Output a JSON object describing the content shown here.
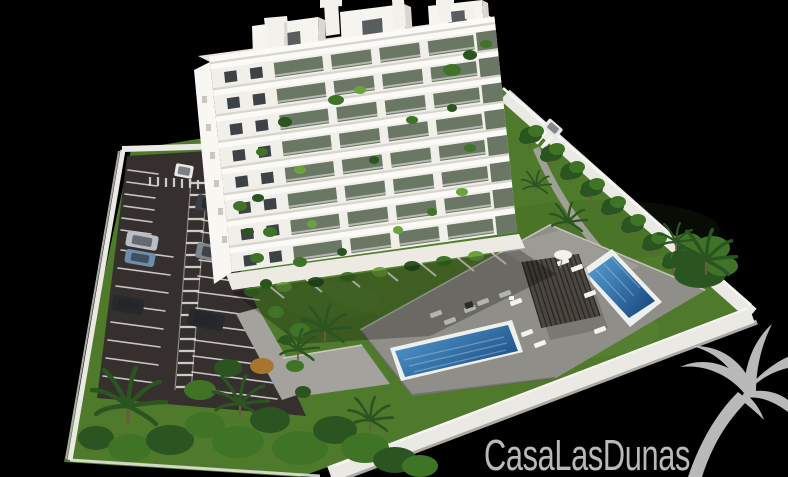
{
  "scene": {
    "type": "architectural-3d-rendering",
    "watermark_text": "CasaLasDunas",
    "watermark_icon": "palm-tree",
    "description": "Aerial 3D render of a white 8-storey apartment building with balcony plants, a striped parking lot with parked cars, landscaped gardens with palm trees, a grey sun deck with two blue swimming pools and a slatted pergola, enclosed by a white perimeter wall on a black background."
  },
  "colors": {
    "background": "#000000",
    "facade": "#f1efe9",
    "facade-left": "#f8f7f2",
    "roof": "#e7e5de",
    "penthouse": "#f5f4ee",
    "penthouse-side": "#d9d7cf",
    "chimney": "#f2f1ec",
    "slab": "#fbfaf6",
    "slab-shadow": "#d8d5cd",
    "glass": "#6b7765",
    "window": "#3d4246",
    "base-band": "#eceae3",
    "lawn": "#4f7a2b",
    "lawn-light": "#76a447",
    "lawn-dark": "#2f5519",
    "asphalt": "#35302e",
    "stripe": "#d4d4d2",
    "wall": "#eae9e3",
    "wall-highlight": "#f7f6f2",
    "wall-shade": "#aaa9a3",
    "deck": "#8f8e88",
    "deck-light": "#a9a8a1",
    "path": "#a3a29c",
    "pool-border": "#eef0ee",
    "pool-light": "#58a0d2",
    "pool-dark": "#1c4e86",
    "pergola": "#45403a",
    "pergola-slat": "#2a2723",
    "lounger": "#f2f2ef",
    "foliage": "#3f7427",
    "foliage-dark": "#2a5420",
    "foliage-light": "#6ca23c",
    "bush-orange": "#a8752f",
    "car-white": "#e9e9e7",
    "car-silver": "#b7bec4",
    "car-blue": "#6d8dac",
    "car-gray": "#7e868d",
    "car-dark": "#3a3f44",
    "car-black": "#26292d",
    "car-glass": "#23262b",
    "watermark": "#c8c8c8"
  }
}
